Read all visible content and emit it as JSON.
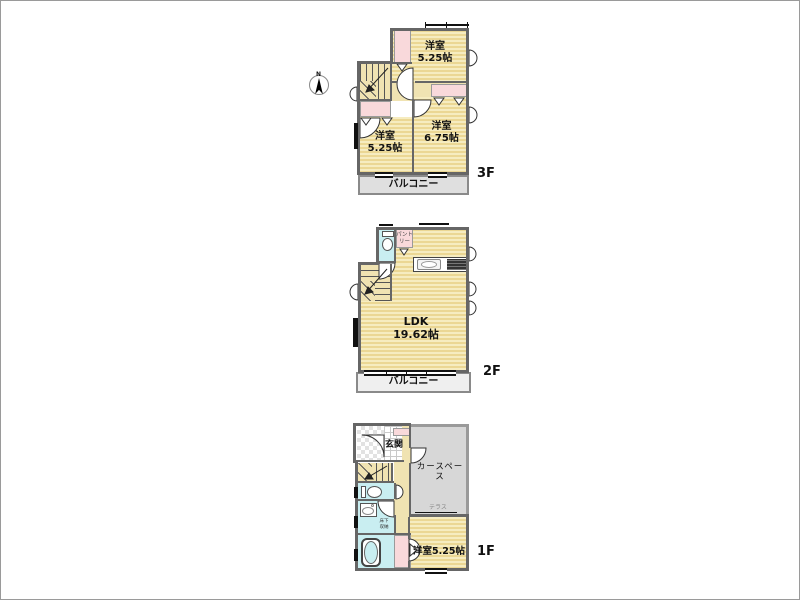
{
  "colors": {
    "wall": "#666666",
    "wall_light": "#9a9a9a",
    "floor_light": "#f6ecc0",
    "floor_stripe": "#ebd794",
    "floor_plain": "#f0e3b2",
    "closet_pink": "#f9d9db",
    "water_cyan": "#c9eef1",
    "balcony_gray": "#dfdfdf",
    "balcony_light": "#efefef",
    "carspace_gray": "#d7d7d7"
  },
  "floors": {
    "f3": {
      "floor_label": "3F",
      "compass_north": "N",
      "bedroom_ne": {
        "name": "洋室",
        "size": "5.25帖"
      },
      "bedroom_sw": {
        "name": "洋室",
        "size": "5.25帖"
      },
      "bedroom_se": {
        "name": "洋室",
        "size": "6.75帖"
      },
      "balcony": "バルコニー"
    },
    "f2": {
      "floor_label": "2F",
      "ldk": {
        "name": "LDK",
        "size": "19.62帖"
      },
      "pantry": "パントリー",
      "balcony": "バルコニー"
    },
    "f1": {
      "floor_label": "1F",
      "entrance": "玄関",
      "carspace": "カースペース",
      "terrace": "テラス",
      "underfloor_storage": "床下収納",
      "bedroom": "洋室5.25帖"
    }
  }
}
